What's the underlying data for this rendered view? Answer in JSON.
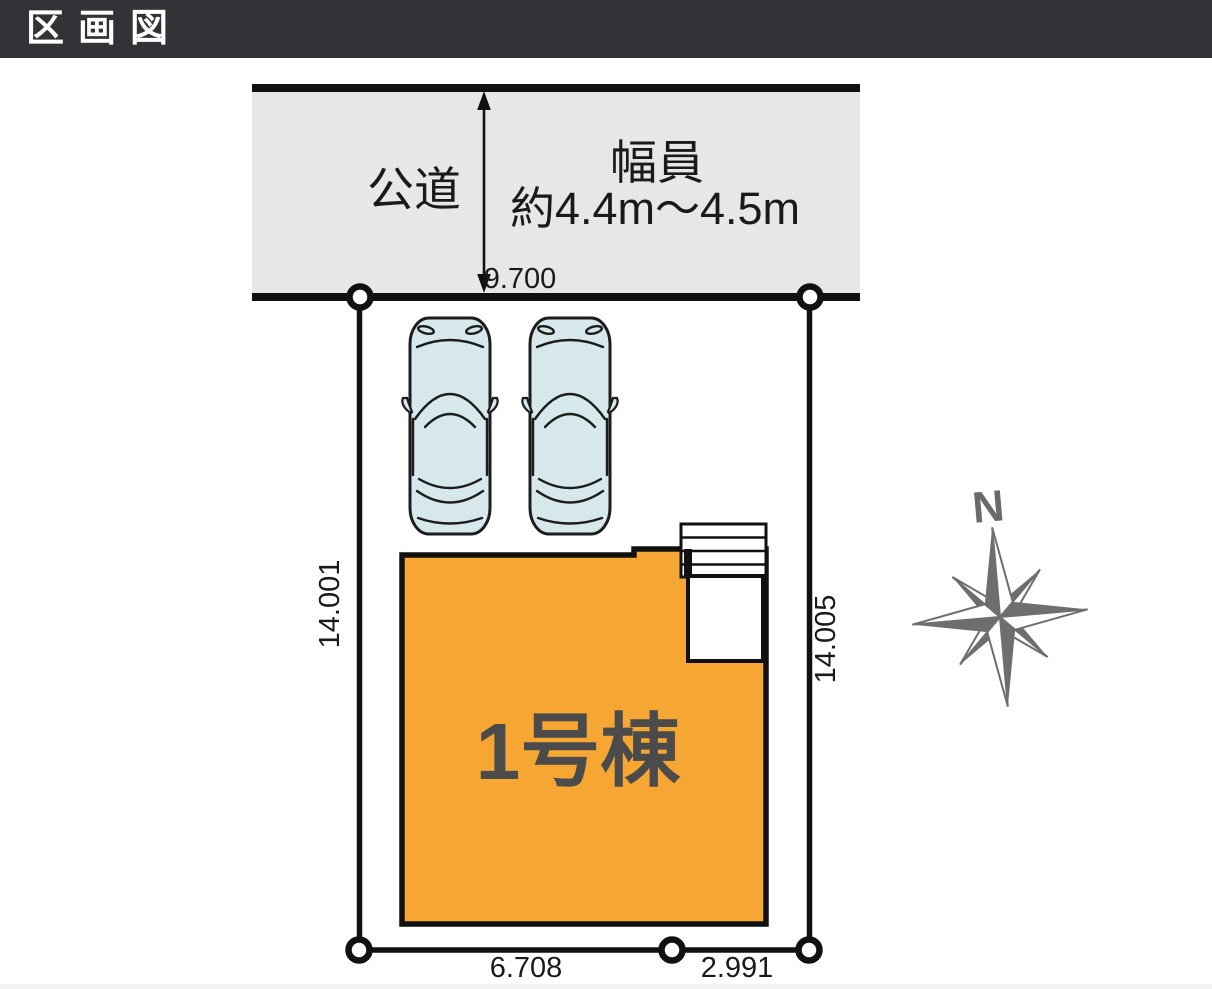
{
  "header": {
    "title": "区画図"
  },
  "colors": {
    "header_bg": "#333337",
    "diagram_line": "#111111",
    "road_fill": "#E7E7E6",
    "building_fill": "#F6A733",
    "building_label_color": "#4B4B4B",
    "car_fill": "#D6E8EC",
    "compass_gray": "#6E6E6E",
    "dimension_text_color": "#1A1A1A"
  },
  "site_plan": {
    "road": {
      "label": "公道",
      "width_caption_line1": "幅員",
      "width_caption_line2": "約4.4m～4.5m"
    },
    "dimensions": {
      "frontage": "9.700",
      "left_side": "14.001",
      "right_side": "14.005",
      "bottom_left": "6.708",
      "bottom_right": "2.991"
    },
    "building": {
      "label": "1号棟"
    },
    "parking": {
      "car_count": "2"
    },
    "compass": {
      "north_label": "N"
    }
  }
}
